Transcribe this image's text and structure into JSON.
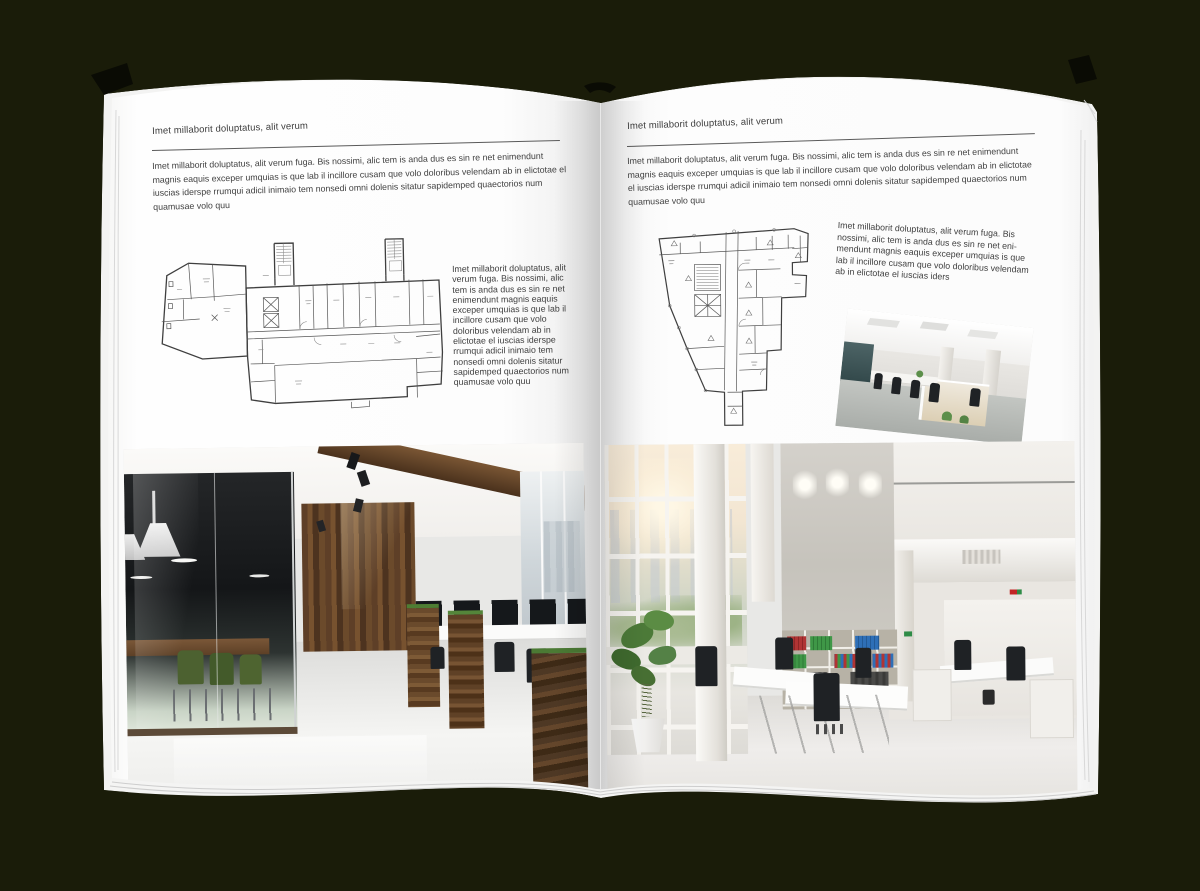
{
  "palette": {
    "background": "#1a1c09",
    "page": "#ffffff",
    "text": "#3d3d3d",
    "wood": "#6a4a2e",
    "chair_green": "#4e6430",
    "binder_red": "#b03434",
    "binder_green": "#3f9747",
    "binder_blue": "#2e6fb7"
  },
  "left_page": {
    "header": "Imet millaborit doluptatus, alit verum",
    "intro": "Imet millaborit doluptatus, alit verum fuga. Bis nossimi, alic tem is anda dus es sin re net enimendunt magnis eaquis exceper umquias is que lab il incillore cusam que volo doloribus velendam ab in elictotae el iuscias iderspe rrumqui adicil inimaio tem nonsedi omni dolenis sitatur sapidemped quaectorios num quamusae volo quu",
    "side_text": "Imet millaborit doluptatus, alit verum fuga. Bis nossimi, alic tem is anda dus es sin re net enimendunt magnis eaquis exceper umquias is que lab il incillore cusam que volo doloribus velendam ab in elictotae el iuscias iderspe rrumqui adicil inimaio tem nonsedi omni dolenis sitatur sapidemped quaectorios num quamusae volo quu"
  },
  "right_page": {
    "header": "Imet millaborit doluptatus, alit verum",
    "intro": "Imet millaborit doluptatus, alit verum fuga. Bis nossimi, alic tem is anda dus es sin re net enimendunt magnis eaquis exceper umquias is que lab il incillore cusam que volo doloribus velendam ab in elictotae el iuscias iderspe rrumqui adicil inimaio tem nonsedi omni dolenis sitatur sapidemped quaectorios num quamusae volo quu",
    "side_text": "Imet millaborit doluptatus, alit verum fuga. Bis nossimi, alic tem is anda dus es sin re net eni-mendunt magnis eaquis exceper umquias is que lab il incillore cusam que volo doloribus velendam ab in elictotae el iuscias iders"
  }
}
